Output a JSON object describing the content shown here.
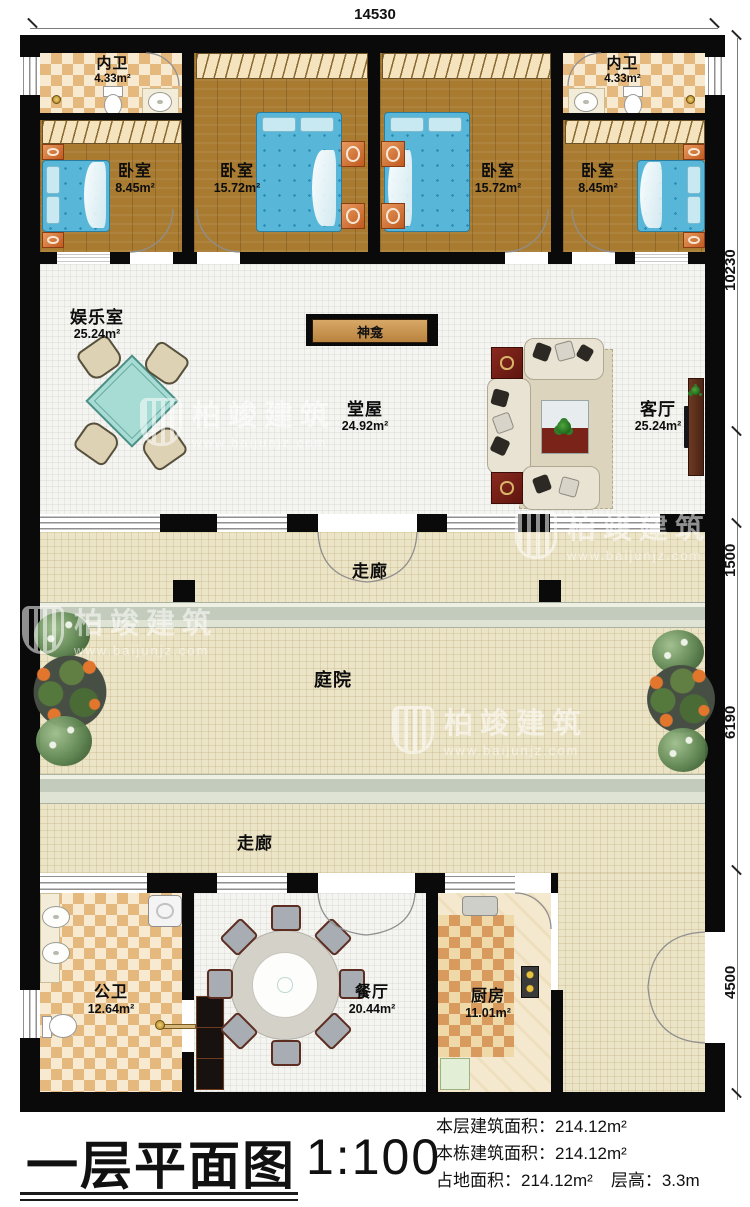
{
  "plan": {
    "dimension_top": "14530",
    "dimensions_right": [
      "10230",
      "1500",
      "6190",
      "4500"
    ]
  },
  "watermark": {
    "brand": "柏竣建筑",
    "url": "www.baijunjz.com"
  },
  "rooms": {
    "neiwei_left": {
      "name": "内卫",
      "area": "4.33m²"
    },
    "neiwei_right": {
      "name": "内卫",
      "area": "4.33m²"
    },
    "bedroom_left_small": {
      "name": "卧室",
      "area": "8.45m²"
    },
    "bedroom_left_large": {
      "name": "卧室",
      "area": "15.72m²"
    },
    "bedroom_right_large": {
      "name": "卧室",
      "area": "15.72m²"
    },
    "bedroom_right_small": {
      "name": "卧室",
      "area": "8.45m²"
    },
    "entertainment": {
      "name": "娱乐室",
      "area": "25.24m²"
    },
    "shrine": {
      "name": "神龛"
    },
    "hall": {
      "name": "堂屋",
      "area": "24.92m²"
    },
    "living": {
      "name": "客厅",
      "area": "25.24m²"
    },
    "corridor_top": {
      "name": "走廊"
    },
    "courtyard": {
      "name": "庭院"
    },
    "corridor_bottom": {
      "name": "走廊"
    },
    "public_bath": {
      "name": "公卫",
      "area": "12.64m²"
    },
    "dining": {
      "name": "餐厅",
      "area": "20.44m²"
    },
    "kitchen": {
      "name": "厨房",
      "area": "11.01m²"
    }
  },
  "title_block": {
    "title": "一层平面图",
    "scale": "1:100",
    "stat1_label": "本层建筑面积：",
    "stat1_value": "214.12m²",
    "stat2_label": "本栋建筑面积：",
    "stat2_value": "214.12m²",
    "stat3_label": "占地面积：",
    "stat3_value": "214.12m²",
    "stat4_label": "层高：",
    "stat4_value": "3.3m"
  }
}
